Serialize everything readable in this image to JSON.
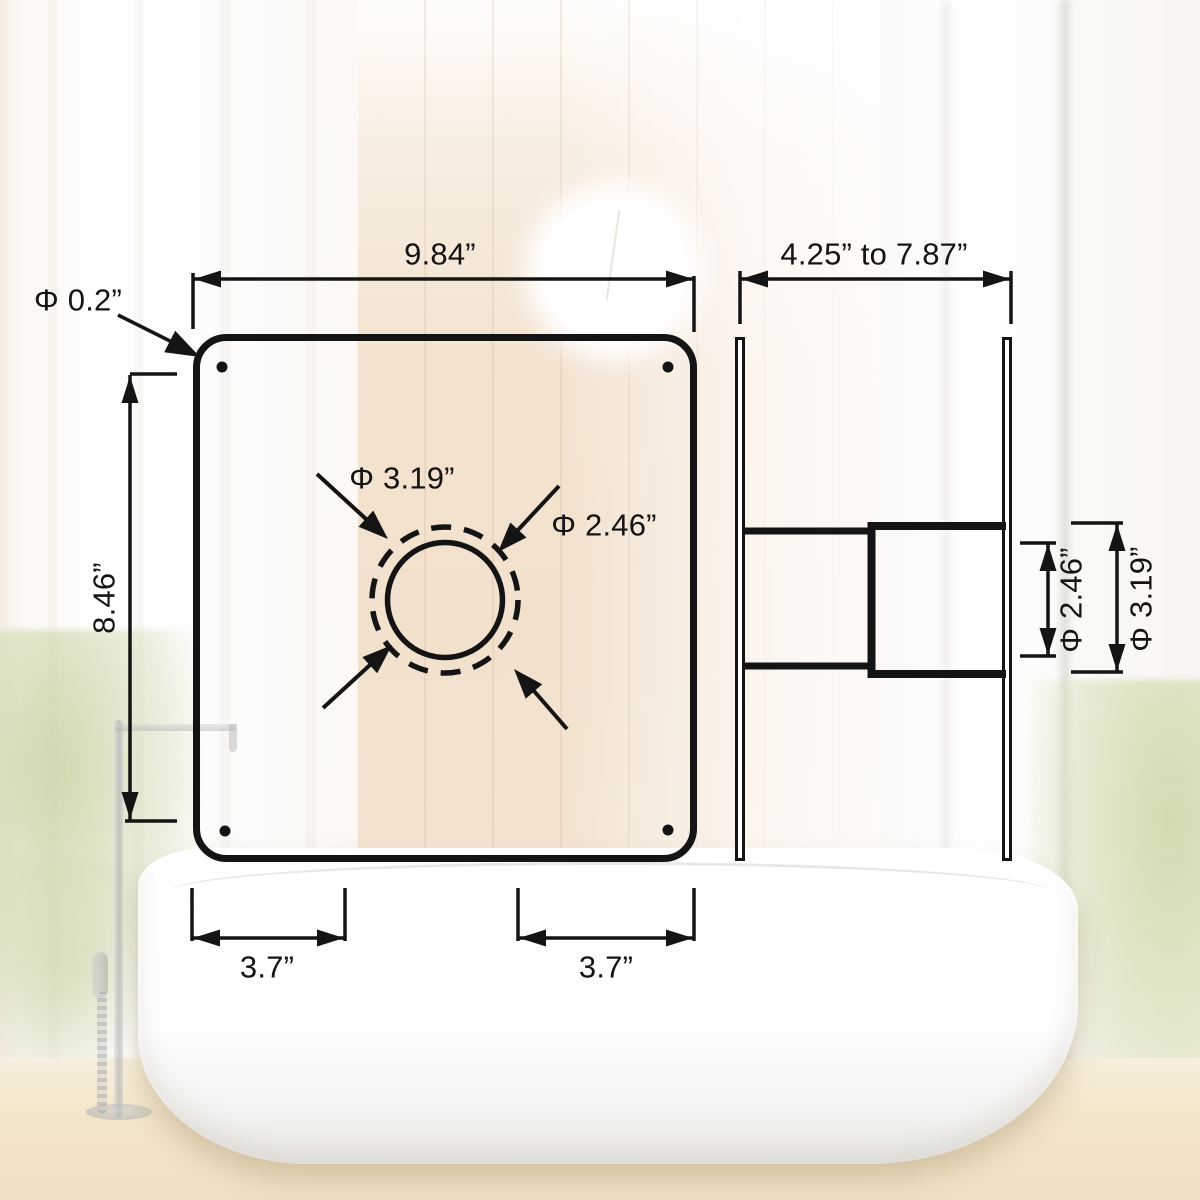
{
  "front_view": {
    "plate_width_label": "9.84”",
    "plate_height_label": "8.46”",
    "corner_hole_dia_label": "Φ 0.2”",
    "duct_outer_dia_label": "Φ 3.19”",
    "duct_inner_dia_label": "Φ 2.46”",
    "hole_spacing_left_label": "3.7”",
    "hole_spacing_right_label": "3.7”"
  },
  "side_view": {
    "depth_range_label": "4.25” to 7.87”",
    "duct_inner_dia_label": "Φ 2.46”",
    "duct_outer_dia_label": "Φ 3.19”"
  },
  "style": {
    "line_color": "#141414",
    "wood_wall_color": "#f2e1cd",
    "floor_color": "#f3e5c9",
    "plant_color": "#cbd6a4",
    "tub_color": "#ffffff"
  }
}
